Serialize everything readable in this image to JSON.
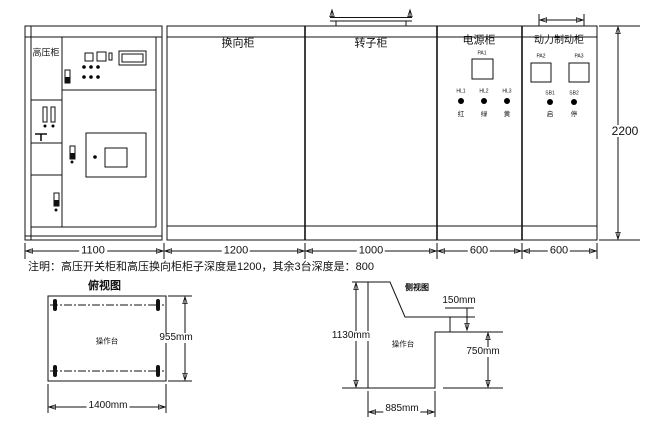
{
  "drawing": {
    "front_view": {
      "cabinets": [
        {
          "label": "高压柜",
          "width": "1100"
        },
        {
          "label": "换向柜",
          "width": "1200"
        },
        {
          "label": "转子柜",
          "width": "1000"
        },
        {
          "label": "电源柜",
          "width": "600"
        },
        {
          "label": "动力制动柜",
          "width": "600"
        }
      ],
      "height": "2200",
      "power_cabinet": {
        "meter_label": "PA1",
        "lamps": [
          {
            "tag": "HL1",
            "char": "红"
          },
          {
            "tag": "HL2",
            "char": "绿"
          },
          {
            "tag": "HL3",
            "char": "黄"
          }
        ]
      },
      "brake_cabinet": {
        "meter_labels": [
          "PA2",
          "PA3"
        ],
        "lamps": [
          {
            "tag": "SB1",
            "char": "启"
          },
          {
            "tag": "SB2",
            "char": "停"
          }
        ]
      }
    },
    "note": "注明：高压开关柜和高压换向柜柜子深度是1200，其余3台深度是：800",
    "top_view": {
      "caption": "俯视图",
      "label": "操作台",
      "width": "1400mm",
      "depth": "955mm"
    },
    "side_view": {
      "caption": "侧视图",
      "label": "操作台",
      "height": "1130mm",
      "step": "150mm",
      "front_height": "750mm",
      "base_depth": "885mm"
    }
  }
}
